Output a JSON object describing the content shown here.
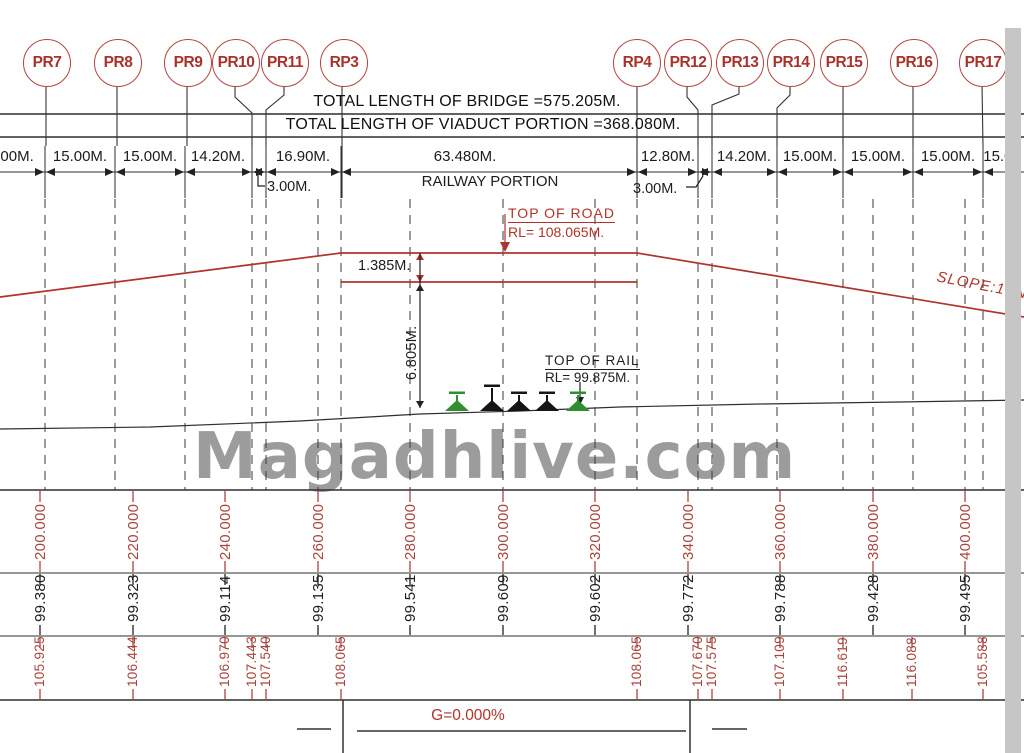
{
  "watermark": "Magadhlive.com",
  "header": {
    "total_bridge": "TOTAL LENGTH OF BRIDGE =575.205M.",
    "total_viaduct": "TOTAL LENGTH OF VIADUCT PORTION =368.080M."
  },
  "piers": [
    {
      "label": "PR7",
      "x": 46
    },
    {
      "label": "PR8",
      "x": 117
    },
    {
      "label": "PR9",
      "x": 187
    },
    {
      "label": "PR10",
      "x": 235
    },
    {
      "label": "PR11",
      "x": 284
    },
    {
      "label": "RP3",
      "x": 343
    },
    {
      "label": "RP4",
      "x": 636
    },
    {
      "label": "PR12",
      "x": 687
    },
    {
      "label": "PR13",
      "x": 739
    },
    {
      "label": "PR14",
      "x": 790
    },
    {
      "label": "PR15",
      "x": 843
    },
    {
      "label": "PR16",
      "x": 913
    },
    {
      "label": "PR17",
      "x": 982
    }
  ],
  "span_labels": [
    {
      "text": ".00M.",
      "x": 15
    },
    {
      "text": "15.00M.",
      "x": 80
    },
    {
      "text": "15.00M.",
      "x": 150
    },
    {
      "text": "14.20M.",
      "x": 218
    },
    {
      "text": "16.90M.",
      "x": 303
    },
    {
      "text": "63.480M.",
      "x": 465
    },
    {
      "text": "12.80M.",
      "x": 668
    },
    {
      "text": "14.20M.",
      "x": 744
    },
    {
      "text": "15.00M.",
      "x": 810
    },
    {
      "text": "15.00M.",
      "x": 878
    },
    {
      "text": "15.00M.",
      "x": 948
    },
    {
      "text": "15.00",
      "x": 1002
    }
  ],
  "annotations": {
    "railway_portion": "RAILWAY PORTION",
    "clearance_left": "3.00M.",
    "clearance_right": "3.00M.",
    "top_of_road": "TOP OF ROAD",
    "top_of_road_rl": "RL= 108.065M.",
    "road_depth": "1.385M.",
    "rail_to_road_height": "6.805M.",
    "top_of_rail": "TOP OF RAIL",
    "top_of_rail_rl": "RL= 99.875M.",
    "slope": "SLOPE:1 IN",
    "grade": "G=0.000%"
  },
  "profile_table": {
    "chainages": [
      {
        "v": "200.000",
        "x": 40
      },
      {
        "v": "220.000",
        "x": 133
      },
      {
        "v": "240.000",
        "x": 225
      },
      {
        "v": "260.000",
        "x": 318
      },
      {
        "v": "280.000",
        "x": 410
      },
      {
        "v": "300.000",
        "x": 503
      },
      {
        "v": "320.000",
        "x": 595
      },
      {
        "v": "340.000",
        "x": 688
      },
      {
        "v": "360.000",
        "x": 780
      },
      {
        "v": "380.000",
        "x": 873
      },
      {
        "v": "400.000",
        "x": 965
      }
    ],
    "ground_levels": [
      {
        "v": "99.380",
        "x": 40
      },
      {
        "v": "99.323",
        "x": 133
      },
      {
        "v": "99.114",
        "x": 225
      },
      {
        "v": "99.135",
        "x": 318
      },
      {
        "v": "99.541",
        "x": 410
      },
      {
        "v": "99.609",
        "x": 503
      },
      {
        "v": "99.602",
        "x": 595
      },
      {
        "v": "99.772",
        "x": 688
      },
      {
        "v": "99.788",
        "x": 780
      },
      {
        "v": "99.428",
        "x": 873
      },
      {
        "v": "99.495",
        "x": 965
      }
    ],
    "design_levels": [
      {
        "v": "105.925",
        "x": 40
      },
      {
        "v": "106.444",
        "x": 133
      },
      {
        "v": "106.970",
        "x": 225
      },
      {
        "v": "107.443",
        "x": 252
      },
      {
        "v": "107.540",
        "x": 266
      },
      {
        "v": "108.065",
        "x": 341
      },
      {
        "v": "108.065",
        "x": 637
      },
      {
        "v": "107.670",
        "x": 698
      },
      {
        "v": "107.575",
        "x": 712
      },
      {
        "v": "107.109",
        "x": 780
      },
      {
        "v": "116.619",
        "x": 843
      },
      {
        "v": "116.088",
        "x": 912
      },
      {
        "v": "105.588",
        "x": 983
      }
    ]
  }
}
